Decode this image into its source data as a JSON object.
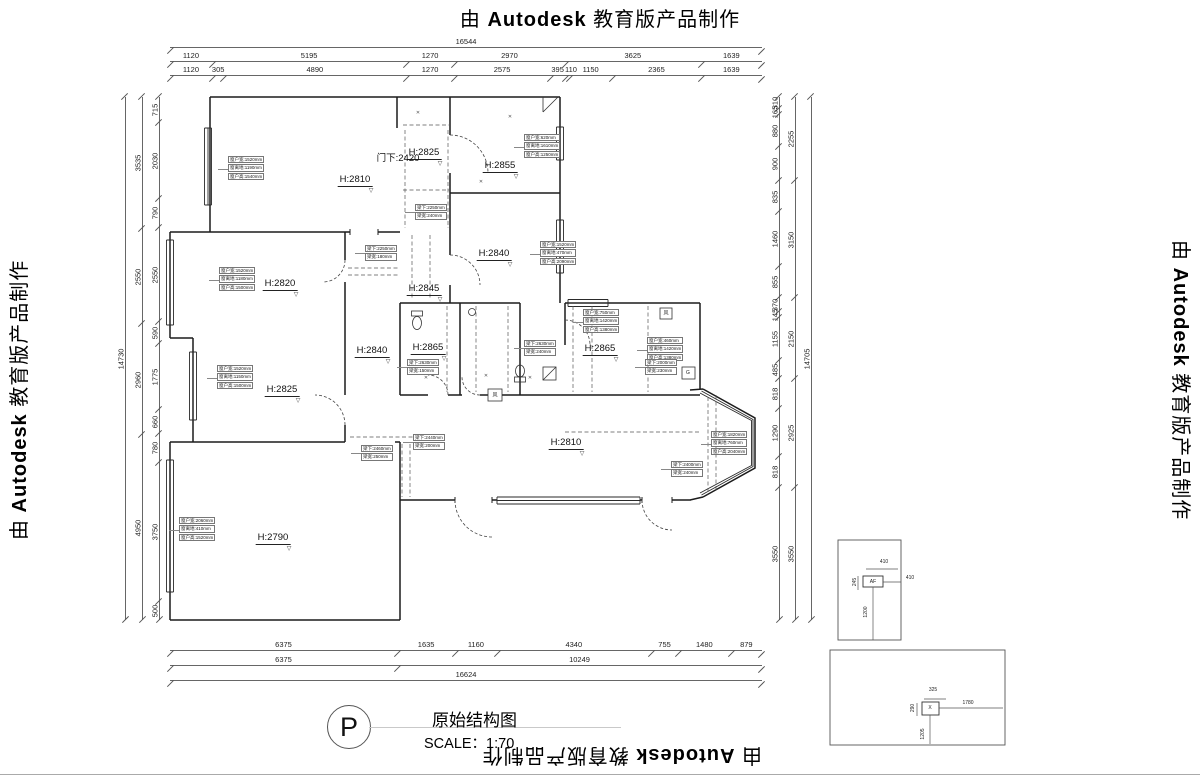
{
  "watermark": {
    "prefix": "由",
    "brand": "Autodesk",
    "suffix": "教育版产品制作"
  },
  "title_block": {
    "symbol": "P",
    "title": "原始结构图",
    "scale": "SCALE：1:70"
  },
  "door_note": "门下:2420",
  "rooms": [
    {
      "label": "H:2810",
      "x": 355,
      "y": 174
    },
    {
      "label": "H:2825",
      "x": 424,
      "y": 147
    },
    {
      "label": "H:2855",
      "x": 500,
      "y": 160
    },
    {
      "label": "H:2840",
      "x": 494,
      "y": 248
    },
    {
      "label": "H:2845",
      "x": 424,
      "y": 283
    },
    {
      "label": "H:2820",
      "x": 280,
      "y": 278
    },
    {
      "label": "H:2840",
      "x": 372,
      "y": 345
    },
    {
      "label": "H:2865",
      "x": 428,
      "y": 342
    },
    {
      "label": "H:2865",
      "x": 600,
      "y": 343
    },
    {
      "label": "H:2825",
      "x": 282,
      "y": 384
    },
    {
      "label": "H:2810",
      "x": 566,
      "y": 437
    },
    {
      "label": "H:2790",
      "x": 273,
      "y": 532
    }
  ],
  "dim_chains": [
    {
      "side": "top",
      "pos": 38,
      "values": [
        "16544"
      ]
    },
    {
      "side": "top",
      "pos": 52,
      "values": [
        "1120",
        "5195",
        "1270",
        "2970",
        "3625",
        "1639"
      ]
    },
    {
      "side": "top",
      "pos": 66,
      "values": [
        "1120",
        "305",
        "4890",
        "1270",
        "2575",
        "395",
        "110",
        "1150",
        "2365",
        "1639"
      ]
    },
    {
      "side": "bottom",
      "pos": 641,
      "values": [
        "6375",
        "1635",
        "1160",
        "4340",
        "755",
        "1480",
        "879"
      ]
    },
    {
      "side": "bottom",
      "pos": 656,
      "values": [
        "6375",
        "10249"
      ]
    },
    {
      "side": "bottom",
      "pos": 671,
      "values": [
        "16624"
      ]
    },
    {
      "side": "left",
      "pos": 116,
      "values": [
        "14730"
      ]
    },
    {
      "side": "left",
      "pos": 133,
      "values": [
        "3535",
        "2550",
        "2960",
        "4950"
      ]
    },
    {
      "side": "left",
      "pos": 150,
      "values": [
        "715",
        "2030",
        "790",
        "2550",
        "590",
        "1775",
        "660",
        "780",
        "3750",
        "500"
      ]
    },
    {
      "side": "right",
      "pos": 770,
      "values": [
        "310",
        "165",
        "880",
        "900",
        "835",
        "1460",
        "855",
        "370",
        "145",
        "1155",
        "485",
        "818",
        "1290",
        "818",
        "3550"
      ]
    },
    {
      "side": "right",
      "pos": 786,
      "values": [
        "2255",
        "3150",
        "2150",
        "2925",
        "3550"
      ]
    },
    {
      "side": "right",
      "pos": 802,
      "values": [
        "14705"
      ]
    }
  ],
  "annotations": [
    {
      "x": 228,
      "y": 156,
      "lines": [
        "窗户宽:1520mm",
        "窗离地:1190mm",
        "窗户高:1540mm"
      ]
    },
    {
      "x": 524,
      "y": 134,
      "lines": [
        "窗户宽:620mm",
        "窗离地:1610mm",
        "窗户高:1250mm"
      ]
    },
    {
      "x": 540,
      "y": 241,
      "lines": [
        "窗户宽:1520mm",
        "窗离地:470mm",
        "窗户高:2090mm"
      ]
    },
    {
      "x": 219,
      "y": 267,
      "lines": [
        "窗户宽:1520mm",
        "窗离地:1180mm",
        "窗户高:1500mm"
      ]
    },
    {
      "x": 217,
      "y": 365,
      "lines": [
        "窗户宽:1520mm",
        "窗离地:1150mm",
        "窗户高:1500mm"
      ]
    },
    {
      "x": 583,
      "y": 309,
      "lines": [
        "窗户宽:750mm",
        "窗离地:1420mm",
        "窗户高:1380mm"
      ]
    },
    {
      "x": 647,
      "y": 337,
      "lines": [
        "窗户宽:460mm",
        "窗离地:1420mm",
        "窗户高:1380mm"
      ]
    },
    {
      "x": 179,
      "y": 517,
      "lines": [
        "窗户宽:2060mm",
        "窗离地:410mm",
        "窗户高:1520mm"
      ]
    },
    {
      "x": 711,
      "y": 431,
      "lines": [
        "窗户宽:1820mm",
        "窗离地:760mm",
        "窗户高:2040mm"
      ]
    },
    {
      "x": 415,
      "y": 204,
      "lines": [
        "梁下:2250mm",
        "梁宽:240mm"
      ]
    },
    {
      "x": 365,
      "y": 245,
      "lines": [
        "梁下:2250mm",
        "梁宽:180mm"
      ]
    },
    {
      "x": 407,
      "y": 359,
      "lines": [
        "梁下:2630mm",
        "梁宽:150mm"
      ]
    },
    {
      "x": 524,
      "y": 340,
      "lines": [
        "梁下:2630mm",
        "梁宽:240mm"
      ]
    },
    {
      "x": 645,
      "y": 359,
      "lines": [
        "梁下:2000mm",
        "梁宽:230mm"
      ]
    },
    {
      "x": 361,
      "y": 445,
      "lines": [
        "梁下:2460mm",
        "梁宽:250mm"
      ]
    },
    {
      "x": 413,
      "y": 434,
      "lines": [
        "梁下:2440mm",
        "梁宽:200mm"
      ]
    },
    {
      "x": 671,
      "y": 461,
      "lines": [
        "梁下:2400mm",
        "梁宽:240mm"
      ]
    }
  ],
  "small_labels": [
    {
      "t": "G",
      "x": 688,
      "y": 373
    },
    {
      "t": "风",
      "x": 495,
      "y": 395
    },
    {
      "t": "风",
      "x": 666,
      "y": 313
    },
    {
      "t": "AF",
      "x": 873,
      "y": 582
    },
    {
      "t": "410",
      "x": 884,
      "y": 562
    },
    {
      "t": "245",
      "x": 855,
      "y": 582,
      "r": 1
    },
    {
      "t": "410",
      "x": 910,
      "y": 578
    },
    {
      "t": "1200",
      "x": 866,
      "y": 612,
      "r": 1
    },
    {
      "t": "X",
      "x": 930,
      "y": 708
    },
    {
      "t": "325",
      "x": 933,
      "y": 690
    },
    {
      "t": "290",
      "x": 913,
      "y": 708,
      "r": 1
    },
    {
      "t": "1780",
      "x": 968,
      "y": 703
    },
    {
      "t": "1205",
      "x": 923,
      "y": 734,
      "r": 1
    },
    {
      "t": "✕",
      "x": 418,
      "y": 113,
      "mark": 1
    },
    {
      "t": "✕",
      "x": 510,
      "y": 117,
      "mark": 1
    },
    {
      "t": "✕",
      "x": 481,
      "y": 182,
      "mark": 1
    },
    {
      "t": "✕",
      "x": 426,
      "y": 378,
      "mark": 1
    },
    {
      "t": "✕",
      "x": 486,
      "y": 376,
      "mark": 1
    },
    {
      "t": "✕",
      "x": 530,
      "y": 378,
      "mark": 1
    }
  ]
}
